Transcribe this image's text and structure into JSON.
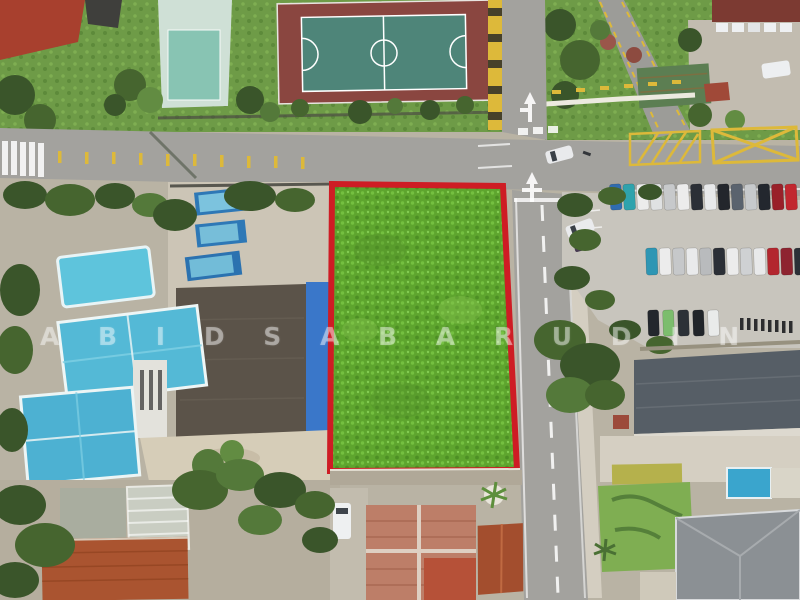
{
  "image": {
    "type": "aerial-drone-photo",
    "description": "Top-down aerial view of a rectangular vacant grass plot outlined in red at a T-junction of roads; futsal court and playing field to the north, blue-roofed houses, blue lorries and a dark-shingle building to the west, a full car park and slate-roofed warehouse to the east, terracotta-roofed houses and lawns to the south."
  },
  "watermark": {
    "text": "A B I D   S A B A R U D I N"
  },
  "palette": {
    "plot_outline_red": "#ce1c24",
    "plot_grass_green": "#5ea52e",
    "surround_grass_green": "#6e9b47",
    "road_asphalt": "#a3a29e",
    "road_marking_yellow": "#ddb93a",
    "road_marking_white": "#ffffff",
    "court_surface_maroon": "#8a4640",
    "court_inner_teal": "#4e8579",
    "blue_tile_roof": "#54b9d6",
    "royal_blue_roof": "#3a77c9",
    "dark_shingle_roof": "#5b5349",
    "warehouse_slate_roof": "#565e66",
    "terracotta_roof": "#aa5430",
    "salmon_tile_roof": "#bd7e68",
    "gray_hip_roof": "#8b9094",
    "parking_concrete": "#c8c5bd",
    "pool_blue": "#3aa5cd",
    "lorry_blue": "#2e78b6",
    "tree_green_dark": "#3a552a"
  },
  "parking": {
    "row1": [
      "#2f6cb0",
      "#2fa3ad",
      "#ececec",
      "#dfe1e2",
      "#c7c9cb",
      "#ececec",
      "#2b2f36",
      "#e8e9ea",
      "#23262c",
      "#5a636e",
      "#c7cacc",
      "#23272e",
      "#992029",
      "#c1272f"
    ],
    "row2": [
      "#2e96b4",
      "#ececec",
      "#c6c8ca",
      "#e9eaeb",
      "#b9bbbd",
      "#2b2f36",
      "#ececec",
      "#cfd1d3",
      "#e8e9ea",
      "#b3262e",
      "#8e2430",
      "#2b3037",
      "#c1272f"
    ],
    "row3": [
      "#23272d",
      "#7cbd6d",
      "#2c3137",
      "#212529",
      "#e9ebea"
    ]
  }
}
